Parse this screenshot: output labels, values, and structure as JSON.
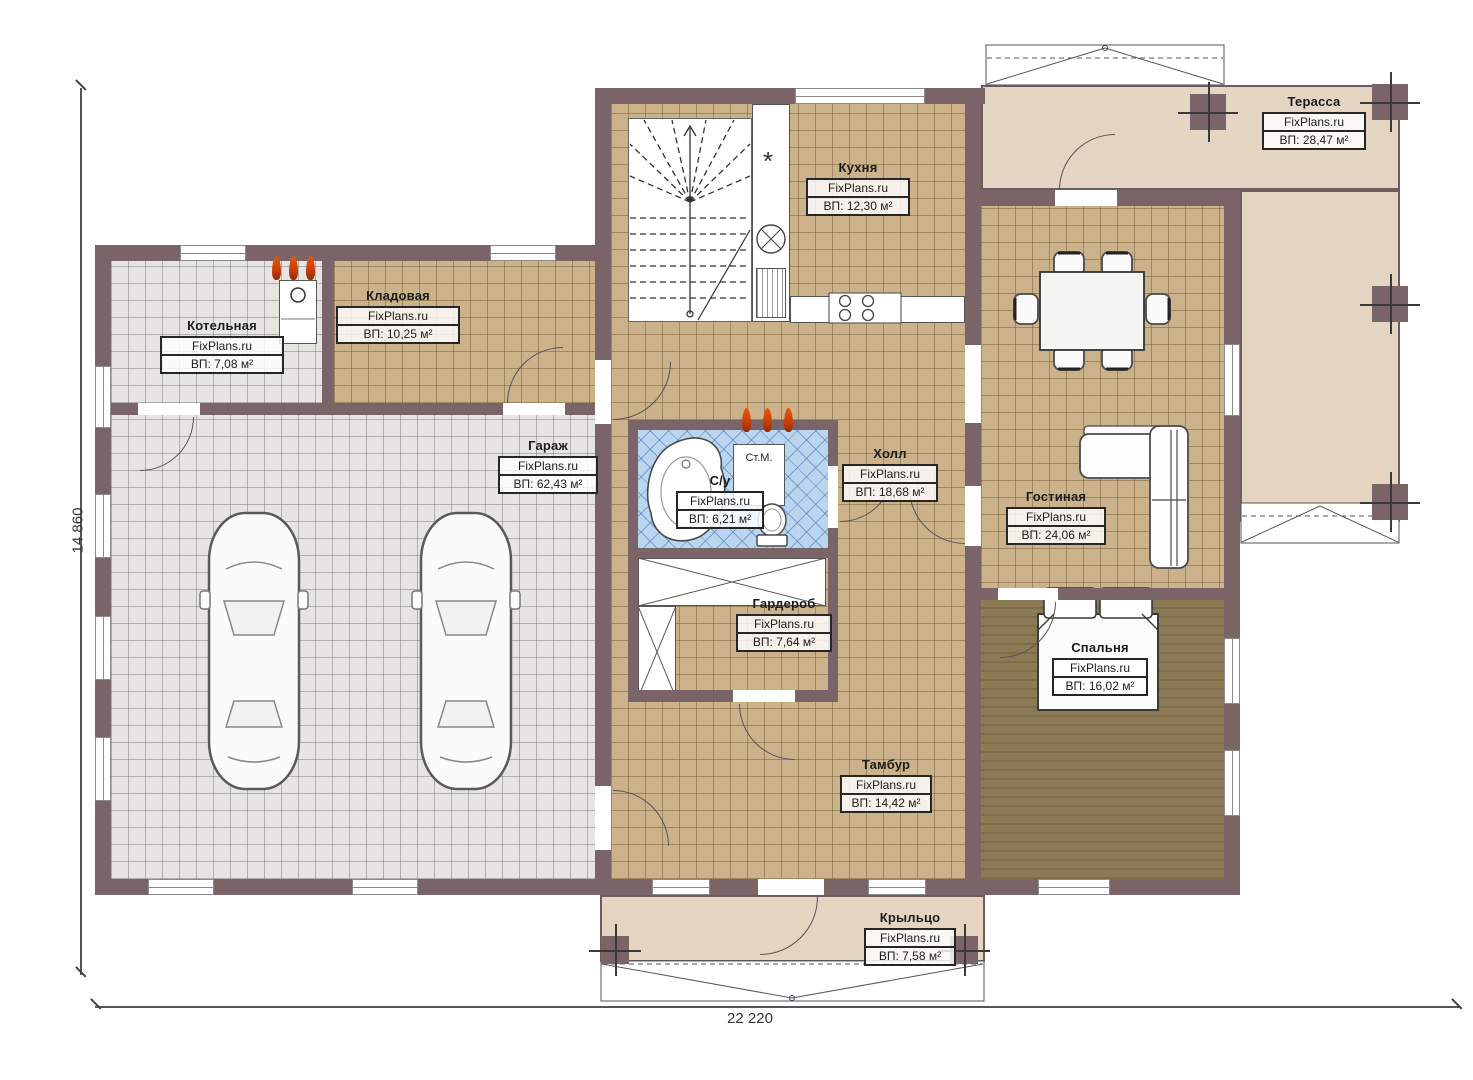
{
  "plan": {
    "brand": "FixPlans.ru",
    "dim_width_label": "22 220",
    "dim_height_label": "14 860",
    "washer_label": "Ст.М.",
    "freezer_symbol": "*",
    "rooms": [
      {
        "name": "Котельная",
        "area": "ВП: 7,08 м²"
      },
      {
        "name": "Кладовая",
        "area": "ВП: 10,25 м²"
      },
      {
        "name": "Гараж",
        "area": "ВП: 62,43 м²"
      },
      {
        "name": "Кухня",
        "area": "ВП: 12,30 м²"
      },
      {
        "name": "Терасса",
        "area": "ВП: 28,47 м²"
      },
      {
        "name": "С/у",
        "area": "ВП: 6,21 м²"
      },
      {
        "name": "Холл",
        "area": "ВП: 18,68 м²"
      },
      {
        "name": "Гостиная",
        "area": "ВП: 24,06 м²"
      },
      {
        "name": "Гардероб",
        "area": "ВП: 7,64 м²"
      },
      {
        "name": "Спальня",
        "area": "ВП: 16,02 м²"
      },
      {
        "name": "Тамбур",
        "area": "ВП: 14,42 м²"
      },
      {
        "name": "Крыльцо",
        "area": "ВП: 7,58 м²"
      }
    ],
    "colors": {
      "wall": "#7a6467",
      "tile_tan": "#cbb28a",
      "tile_gray": "#e6e5e2",
      "tile_blue": "#b9d5f0",
      "floor_dark": "#8c7a55",
      "terrace": "#e3d5c1",
      "flame": "#e8590c",
      "label_bg": "rgba(255,255,255,0.82)"
    }
  }
}
